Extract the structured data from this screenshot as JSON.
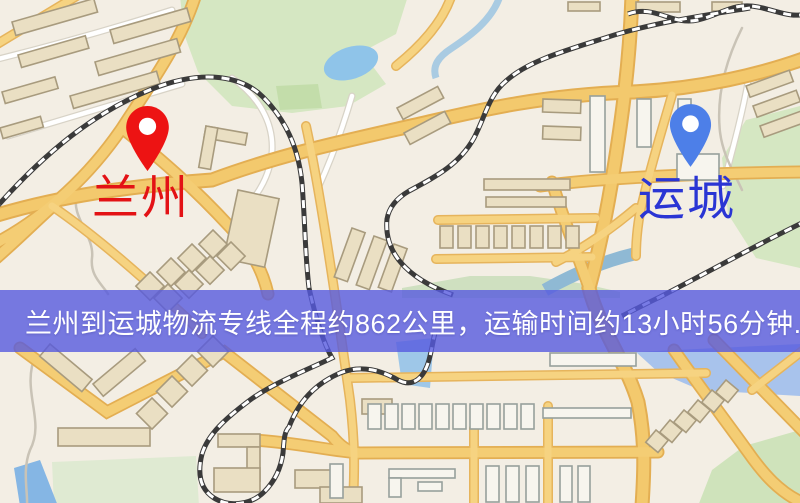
{
  "map": {
    "banner": {
      "text": "兰州到运城物流专线全程约862公里，运输时间约13小时56分钟."
    },
    "origin": {
      "label": "兰州",
      "pin_color": "#ed1313"
    },
    "destination": {
      "label": "运城",
      "pin_color": "#4d7fe8"
    },
    "colors": {
      "origin_label": "#e31215",
      "destination_label": "#2a35d4",
      "banner_bg": "rgba(86,90,222,0.8)",
      "banner_text": "#ffffff"
    }
  }
}
